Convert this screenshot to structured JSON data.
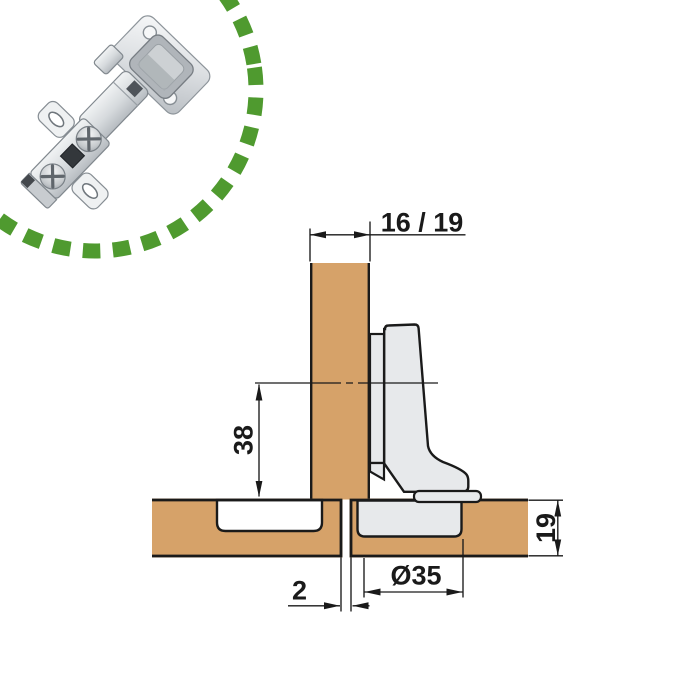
{
  "product_photo": {
    "subject": "concealed cabinet hinge photo",
    "circle_color": "#4f9a2f"
  },
  "diagram": {
    "dimensions": {
      "panel_thickness": "16 / 19",
      "hinge_axis_to_door_edge": "38",
      "door_thickness": "19",
      "cup_diameter": "Ø35",
      "door_gap": "2"
    },
    "colors": {
      "wood": "#d6a269",
      "metal": "#e7e9eb",
      "line": "#1a1a1a",
      "recess": "#ffffff"
    }
  }
}
